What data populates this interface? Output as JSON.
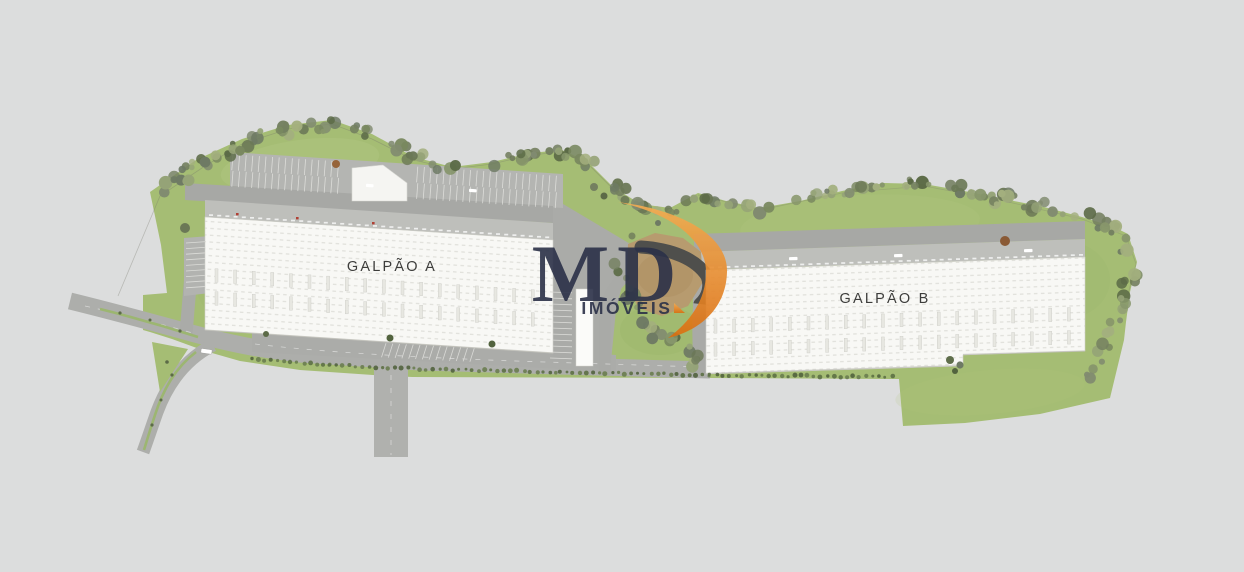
{
  "page": {
    "title": "Aerial site plan rendering",
    "background_color": "#dcdddd"
  },
  "site": {
    "buildings": [
      {
        "id": "galpao-a",
        "label": "GALPÃO A"
      },
      {
        "id": "galpao-b",
        "label": "GALPÃO B"
      }
    ],
    "label_color": "#3d3d3b"
  },
  "watermark": {
    "brand": "MD",
    "subtitle": "IMÓVEIS",
    "letter_color": "#2b3148",
    "swoosh_gradient_top": "#f5ae54",
    "swoosh_gradient_bottom": "#db6f10"
  },
  "palette": {
    "grass": "#a5bd74",
    "grass_light": "#c3d293",
    "tree_dark": "#5c6b47",
    "road": "#abaca9",
    "parking": "#b4b5b2",
    "dock": "#bebfbb",
    "roof_white": "#f8f8f5",
    "dirt": "#b79b6f",
    "hedge": "#5d7045"
  }
}
